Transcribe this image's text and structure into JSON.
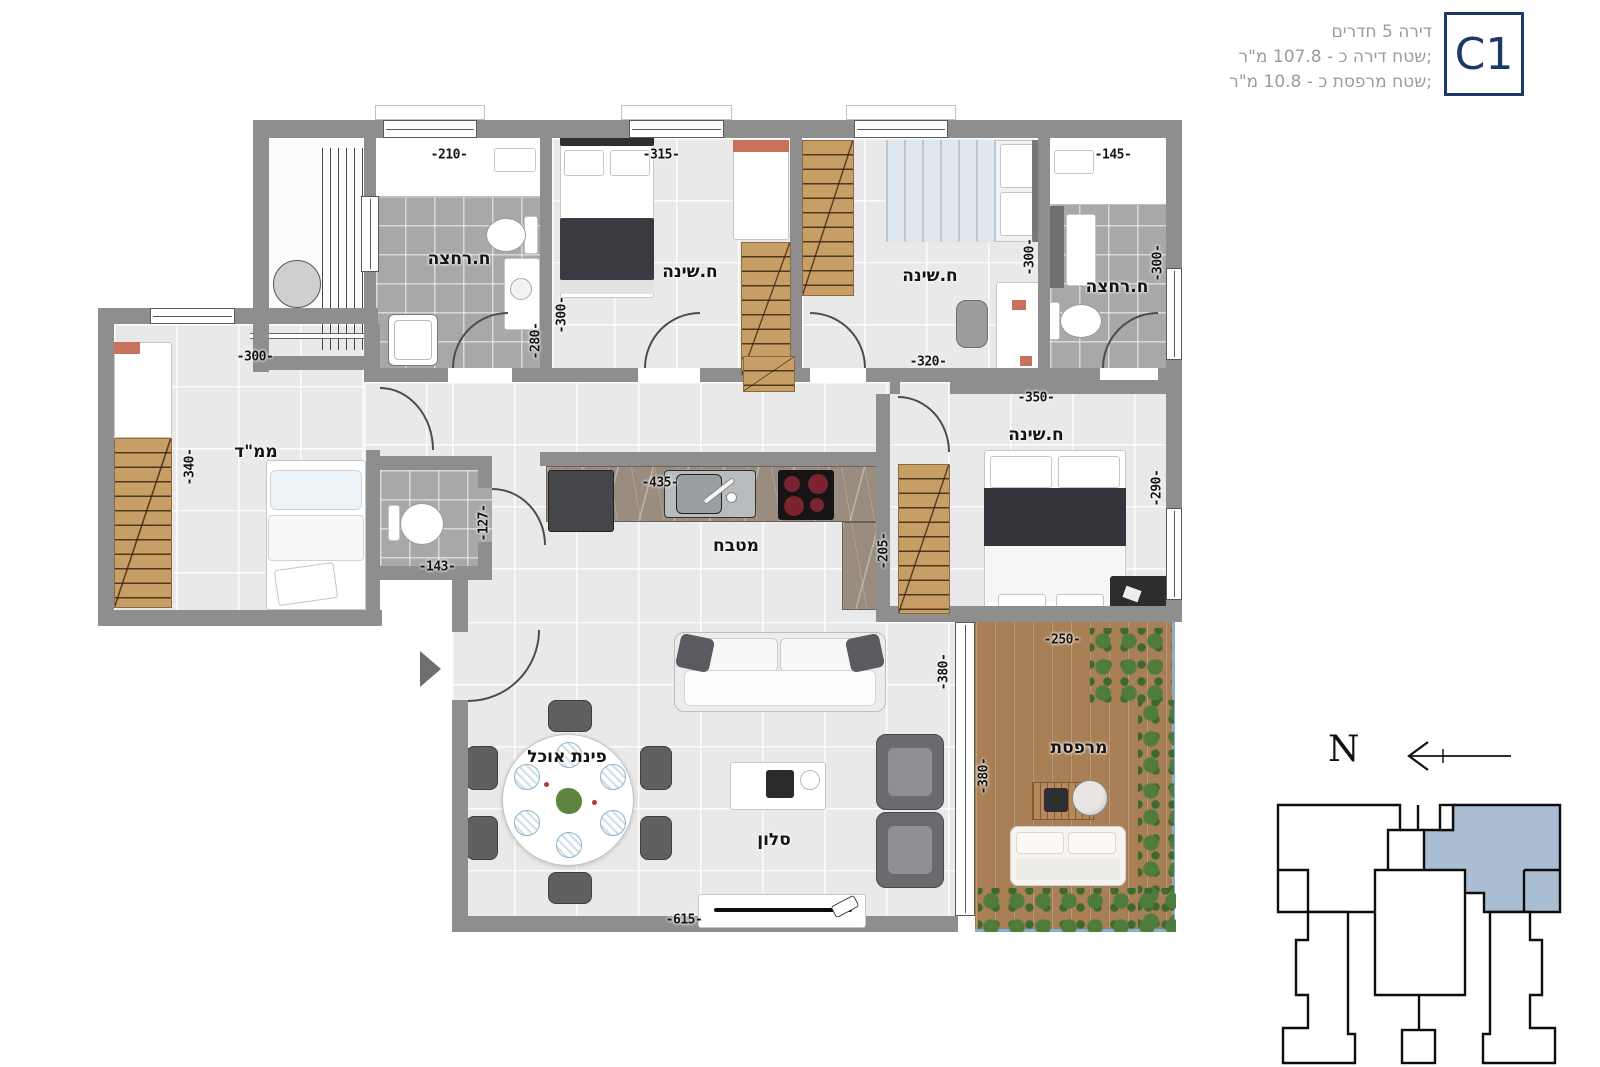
{
  "header": {
    "line1": "דירה 5 חדרים",
    "line2": "שטח דירה כ - 107.8 מ\"ר;",
    "line3": "שטח מרפסת כ - 10.8 מ\"ר;",
    "unit_label": "C1"
  },
  "compass": {
    "north_label": "N"
  },
  "rooms": {
    "bath1": "ח.רחצה",
    "bed1": "ח.שינה",
    "bed2": "ח.שינה",
    "bath2": "ח.רחצה",
    "mamad": "ממ\"ד",
    "kitchen": "מטבח",
    "bed3": "ח.שינה",
    "dining": "פינת אוכל",
    "living": "סלון",
    "balcony": "מרפסת"
  },
  "dims": {
    "d210": "-210-",
    "d315": "-315-",
    "d145": "-145-",
    "d280": "-280-",
    "d300a": "-300-",
    "d300b": "-300-",
    "d300c": "-300-",
    "d300d": "-300-",
    "d320": "-320-",
    "d350": "-350-",
    "d340": "-340-",
    "d143": "-143-",
    "d127": "-127-",
    "d435": "-435-",
    "d205": "-205-",
    "d290": "-290-",
    "d380a": "-380-",
    "d250": "-250-",
    "d380b": "-380-",
    "d615": "-615-"
  },
  "colors": {
    "unit_accent": "#1d3a66",
    "keyplan_highlight": "#a9bdd3",
    "wall": "#8e8e8e",
    "wood": "#c79e66",
    "deck": "#a97f55",
    "plants": "#4f7c3b"
  }
}
